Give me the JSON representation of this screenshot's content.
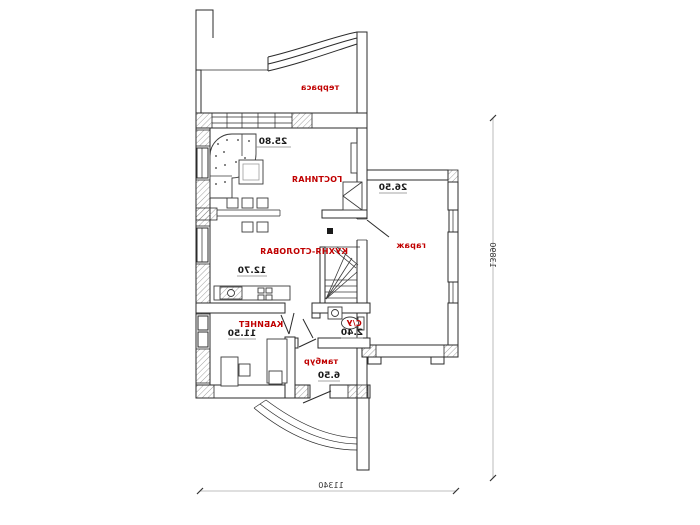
{
  "plan": {
    "rooms": [
      {
        "name": "терраса",
        "area": ""
      },
      {
        "name": "ГОСТИНАЯ",
        "area": "25.80"
      },
      {
        "name": "КУХНЯ-СТОЛОВАЯ",
        "area": "12.70"
      },
      {
        "name": "гараж",
        "area": "26.50"
      },
      {
        "name": "КАБИНЕТ",
        "area": "11.50"
      },
      {
        "name": "С/У",
        "area": "2.40"
      },
      {
        "name": "тамбур",
        "area": "6.50"
      }
    ],
    "dims": {
      "bottom": "11340",
      "right": "13890"
    },
    "colors": {
      "label": "#c00000",
      "area": "#1a1a1a",
      "wall": "#2b2b2b",
      "dim_line": "#aaaaaa",
      "dim_text": "#333333",
      "background": "#ffffff"
    }
  }
}
